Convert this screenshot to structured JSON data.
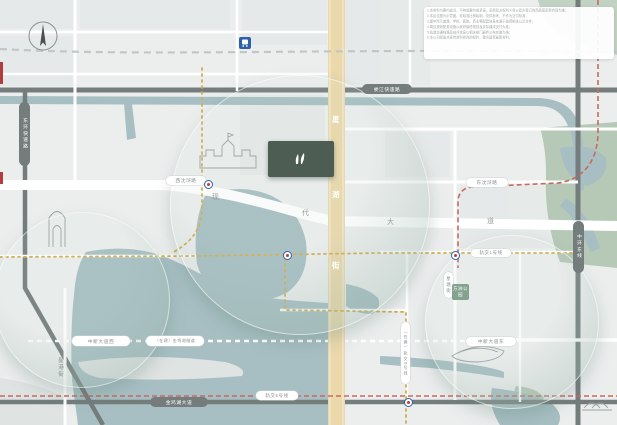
{
  "logo": {
    "name": "朗拾",
    "sub": "ILE MAISON",
    "color": "#4d5d53"
  },
  "compass": {
    "label": "北/North"
  },
  "zones": {
    "hudong": "湖东核心CBD",
    "huxi": "湖西CBD",
    "aoti": "奥体板块",
    "lake": "金鸡湖"
  },
  "disclaimer": {
    "lines": [
      "1.本资料为要约邀请，不构成要约或承诺，买卖双方权利义务以双方签订的商品房买卖合同为准；",
      "2.本区位图为示意图，非精准比例绘制，仅供参考，不作为交付标准；",
      "3.图中所示道路、学校、医院、商业等配套信息来源于政府相关公示文件；",
      "4.周边规划配套设施以政府最终规划及实际建成交付为准；",
      "5.轨道交通线路及站点信息以相关部门最终公布实施为准；",
      "6.本公司保留对宣传资料修改的权利，敬请留意最新资料。"
    ]
  },
  "map": {
    "accent_gold_road": "#ebd8ab",
    "water_color": "#a7bfc3",
    "park_color": "#b6c9b7",
    "labels": [
      {
        "n": "north-label",
        "x": 34,
        "y": 20,
        "text": "北/North",
        "fs": 4.5,
        "color": "#777777"
      },
      {
        "n": "xinsu-industrial",
        "x": 114,
        "y": 14,
        "text": "新苏工业坊",
        "icon": "bld",
        "side": "r"
      },
      {
        "n": "aosheng-plaza",
        "x": 132,
        "y": 38,
        "text": "禧中奥盛生活广场",
        "icon": "shop",
        "side": "r"
      },
      {
        "n": "times-shopping-plaza",
        "x": 134,
        "y": 54,
        "text": "苏州时代购物广场",
        "icon": "shop",
        "side": "l"
      },
      {
        "n": "hotel-pingjiang",
        "x": 237,
        "y": 13,
        "text": "平江国际酒店",
        "icon": "bld",
        "side": "r"
      },
      {
        "n": "suzhou-park-station",
        "x": 229,
        "y": 54,
        "text": "苏州园区站",
        "fs": 5.5,
        "bold": true,
        "color": "#2c3a46"
      },
      {
        "n": "vanke-life-plaza",
        "x": 137,
        "y": 154,
        "text": "万科生活广场",
        "icon": "shop",
        "side": "r"
      },
      {
        "n": "xinghai-school",
        "x": 210,
        "y": 166,
        "text": "星海实验中学",
        "fs": 5.2
      },
      {
        "n": "expo-center",
        "x": 151,
        "y": 214,
        "text": "苏州国际博览中心",
        "icon": "bld",
        "side": "r"
      },
      {
        "n": "culture-art-center",
        "x": 166,
        "y": 225,
        "lines": [
          "苏州文化",
          "艺术中心"
        ],
        "icon": "bld",
        "side": "l"
      },
      {
        "n": "wenbo-plaza",
        "x": 196,
        "y": 232,
        "text": "文博商业广场",
        "icon": "shop",
        "side": "l"
      },
      {
        "n": "shinkong-place",
        "x": 253,
        "y": 232,
        "text": "新光天地",
        "icon": "shop",
        "side": "l"
      },
      {
        "n": "moonlight-wharf",
        "x": 193,
        "y": 261,
        "text": "月光码头",
        "icon": "shop",
        "side": "l"
      },
      {
        "n": "eslite-bookstore",
        "x": 229,
        "y": 261,
        "text": "诚品书店",
        "icon": "shop",
        "side": "r"
      },
      {
        "n": "harmony-times-square",
        "x": 257,
        "y": 272,
        "text": "圆融时代广场",
        "icon": "shop",
        "side": "l"
      },
      {
        "n": "jiuguang-dept",
        "x": 279,
        "y": 286,
        "text": "久光百货",
        "icon": "shop",
        "side": "l"
      },
      {
        "n": "harmony-mall",
        "x": 281,
        "y": 298,
        "text": "圆融购物中心",
        "icon": "shop",
        "side": "l"
      },
      {
        "n": "wharf-ifc",
        "x": 296,
        "y": 251,
        "lines": [
          "苏州九龙仓",
          "国际金融中心"
        ],
        "icon": "bld",
        "side": "b"
      },
      {
        "n": "sip-administration",
        "x": 352,
        "y": 235,
        "lines": [
          "苏州工业园区",
          "管理委员会"
        ],
        "icon": "gov",
        "side": "t"
      },
      {
        "n": "sip-service-center",
        "x": 415,
        "y": 234,
        "lines": [
          "苏州工业园区",
          "行政服务中心"
        ],
        "icon": "bld",
        "side": "l"
      },
      {
        "n": "jiulong-hospital",
        "x": 392,
        "y": 187,
        "text": "九龙医院",
        "icon": "hosp",
        "side": "b"
      },
      {
        "n": "jingcheng-neighborhood",
        "x": 384,
        "y": 206,
        "text": "景城邻里中心",
        "icon": "shop",
        "side": "l"
      },
      {
        "n": "samsung-electronics",
        "x": 487,
        "y": 145,
        "text": "苏州三星电子有限公司",
        "icon": "bld",
        "side": "l"
      },
      {
        "n": "dongshahu-neighborhood",
        "x": 487,
        "y": 192,
        "text": "东沙湖邻里中心",
        "icon": "shop",
        "side": "r"
      },
      {
        "n": "vanke-city-garden",
        "x": 457,
        "y": 201,
        "text": "万科城市花园",
        "icon": "shop",
        "side": "l"
      },
      {
        "n": "hudong-neighborhood",
        "x": 358,
        "y": 296,
        "text": "湖东邻里中心",
        "icon": "shop",
        "side": "l"
      },
      {
        "n": "modern-media-plaza",
        "x": 380,
        "y": 258,
        "text": "现代传媒广场",
        "icon": "bld",
        "side": "r"
      },
      {
        "n": "dongshahu-eco-park",
        "x": 589,
        "y": 192,
        "lines": [
          "东沙湖",
          "生态公园"
        ],
        "color": "#ffffff",
        "fs": 4.8
      },
      {
        "n": "aeon-mall",
        "x": 492,
        "y": 272,
        "text": "永旺梦乐城",
        "icon": "shop",
        "side": "r"
      },
      {
        "n": "yuanhe-qingyue",
        "x": 473,
        "y": 288,
        "lines": [
          "元禾青",
          "悦景中心"
        ],
        "icon": "shop",
        "side": "r"
      },
      {
        "n": "xinghui-school",
        "x": 523,
        "y": 292,
        "text": "星汇学校",
        "icon": "sch",
        "side": "l"
      },
      {
        "n": "fangzhou-primary",
        "x": 477,
        "y": 310,
        "lines": [
          "苏州工业园区",
          "方洲小学"
        ],
        "icon": "sch",
        "side": "l"
      },
      {
        "n": "children-hospital",
        "x": 524,
        "y": 309,
        "lines": [
          "苏州大学附属",
          "儿童医院园区总院"
        ],
        "icon": "hosp",
        "side": "l"
      },
      {
        "n": "sports-center",
        "x": 462,
        "y": 359,
        "text": "奥体中心",
        "fs": 5.2
      },
      {
        "n": "foreign-language-school",
        "x": 508,
        "y": 346,
        "lines": [
          "苏州工业园区",
          "外国语学校"
        ],
        "icon": "sch",
        "side": "l"
      },
      {
        "n": "yihe-linglong",
        "x": 512,
        "y": 367,
        "text": "颐和玲珑",
        "icon": "bld",
        "side": "l"
      },
      {
        "n": "meisong-center",
        "x": 455,
        "y": 371,
        "text": "美颂中心",
        "icon": "shop",
        "side": "l"
      },
      {
        "n": "xinglan-school",
        "x": 487,
        "y": 381,
        "text": "星澜学校",
        "icon": "sch",
        "side": "l"
      },
      {
        "n": "vanke-cofco",
        "x": 420,
        "y": 378,
        "text": "万科中粮本岸",
        "icon": "bld",
        "side": "l"
      },
      {
        "n": "jinhua-center",
        "x": 382,
        "y": 366,
        "text": "锦华中心",
        "icon": "bld",
        "side": "l"
      },
      {
        "n": "rtmart-hudong",
        "x": 460,
        "y": 394,
        "text": "湖东大润发",
        "icon": "shop",
        "side": "l"
      },
      {
        "n": "xinghu-hospital",
        "x": 408,
        "y": 407,
        "text": "星湖医院",
        "icon": "hosp",
        "side": "l"
      },
      {
        "n": "dulwich-school",
        "x": 589,
        "y": 344,
        "lines": [
          "苏州德威",
          "国际高中"
        ],
        "icon": "bld",
        "side": "t"
      },
      {
        "n": "kempinski-hotel",
        "x": 225,
        "y": 406,
        "text": "凯宾斯基酒店",
        "icon": "bld",
        "side": "l"
      },
      {
        "n": "linrui-plaza",
        "x": 288,
        "y": 406,
        "text": "邻瑞广场",
        "icon": "shop",
        "side": "r"
      },
      {
        "n": "xietang-old-street",
        "x": 351,
        "y": 362,
        "text": "斜塘老街",
        "icon": "shop",
        "side": "l"
      },
      {
        "n": "ligongdi",
        "x": 108,
        "y": 354,
        "text": "李公堤",
        "icon": "bld",
        "side": "l"
      },
      {
        "n": "jinji-lake",
        "x": 141,
        "y": 302,
        "text": "金鸡湖",
        "fs": 9,
        "color": "#8fa9ac",
        "ls": 7
      },
      {
        "n": "huxi-cbd",
        "x": 34,
        "y": 269,
        "text": "湖西CBD",
        "fs": 12,
        "bold": true,
        "color": "#6f9c97",
        "ls": 1
      },
      {
        "n": "suzhou-center",
        "x": 20,
        "y": 234,
        "lines": [
          "苏州",
          "中心"
        ],
        "icon": "shop",
        "side": "t",
        "fs": 4.3
      },
      {
        "n": "gate-of-orient",
        "x": 46,
        "y": 242,
        "text": "东方之门",
        "fs": 4.5
      },
      {
        "n": "linglong-business-center",
        "x": 21,
        "y": 255,
        "text": "玲珑商务中心",
        "icon": "bld",
        "side": "t"
      },
      {
        "n": "hudong-core-cbd",
        "x": 249,
        "y": 186,
        "text": "湖东核心CBD",
        "fs": 13,
        "bold": true,
        "color": "#33524c",
        "ls": 1.5
      },
      {
        "n": "aoti-zone",
        "x": 485,
        "y": 323,
        "text": "奥体板块",
        "fs": 12,
        "bold": true,
        "color": "#5b8a82",
        "ls": 3
      }
    ],
    "pills": [
      {
        "n": "loujiang-expressway",
        "text": "娄江快速路",
        "x": 362,
        "y": 84,
        "w": 50,
        "h": 10,
        "k": "dark"
      },
      {
        "n": "donghuan-expressway",
        "text": "东环快速路",
        "x": 19,
        "y": 102,
        "w": 11,
        "h": 64,
        "k": "dark",
        "v": true
      },
      {
        "n": "zhonghuan-east",
        "text": "中环东线",
        "x": 573,
        "y": 221,
        "w": 11,
        "h": 52,
        "k": "dark",
        "v": true
      },
      {
        "n": "jinjihu-avenue",
        "text": "金鸡湖大道",
        "x": 150,
        "y": 397,
        "w": 58,
        "h": 10,
        "k": "dark"
      },
      {
        "n": "xishenhu-road",
        "text": "西沈浒路",
        "x": 166,
        "y": 176,
        "w": 40,
        "h": 9,
        "k": "white"
      },
      {
        "n": "dongshenhu-road",
        "text": "东沈浒路",
        "x": 466,
        "y": 178,
        "w": 42,
        "h": 9,
        "k": "white"
      },
      {
        "n": "zhongxin-avenue-west",
        "text": "中新大道西",
        "x": 72,
        "y": 336,
        "w": 58,
        "h": 10,
        "k": "white"
      },
      {
        "n": "jinjihu-tunnel",
        "text": "（在建）金鸡湖隧道",
        "x": 146,
        "y": 336,
        "w": 58,
        "h": 10,
        "k": "white",
        "fs": 4
      },
      {
        "n": "zhongxin-avenue-east",
        "text": "中新大道东",
        "x": 466,
        "y": 337,
        "w": 50,
        "h": 9,
        "k": "white"
      },
      {
        "n": "metro-line1",
        "text": "轨交1号线",
        "x": 471,
        "y": 249,
        "w": 40,
        "h": 8,
        "k": "white",
        "fs": 4.5
      },
      {
        "n": "metro-line5",
        "text": "轨交5号线",
        "x": 256,
        "y": 391,
        "w": 42,
        "h": 9,
        "k": "white",
        "fs": 4.5
      },
      {
        "n": "xingtang-street",
        "text": "星塘街",
        "x": 444,
        "y": 272,
        "w": 9,
        "h": 26,
        "k": "white",
        "v": true,
        "fs": 4.5
      },
      {
        "n": "metro-line6",
        "text": "（在建）轨交6号线",
        "x": 401,
        "y": 322,
        "w": 9,
        "h": 62,
        "k": "white",
        "v": true,
        "fs": 4
      },
      {
        "n": "fangzhou-park",
        "text": "方洲公园",
        "x": 452,
        "y": 284,
        "w": 17,
        "h": 16,
        "k": "green",
        "fs": 4.5
      },
      {
        "n": "xinggang-street",
        "text": "星港街",
        "x": 55,
        "y": 351,
        "w": 10,
        "h": 32,
        "k": "plain",
        "v": true,
        "fs": 5.5
      }
    ],
    "road_chars": [
      {
        "n": "modern-avenue-char1",
        "t": "现",
        "x": 212,
        "y": 192,
        "c": "#979e9d"
      },
      {
        "n": "modern-avenue-char2",
        "t": "代",
        "x": 302,
        "y": 208,
        "c": "#979e9d"
      },
      {
        "n": "modern-avenue-char3",
        "t": "大",
        "x": 387,
        "y": 217,
        "c": "#979e9d"
      },
      {
        "n": "modern-avenue-char4",
        "t": "道",
        "x": 487,
        "y": 216,
        "c": "#979e9d"
      },
      {
        "n": "xinghu-street-char1",
        "t": "星",
        "x": 332,
        "y": 114,
        "c": "#ffffff"
      },
      {
        "n": "xinghu-street-char2",
        "t": "湖",
        "x": 332,
        "y": 189,
        "c": "#ffffff"
      },
      {
        "n": "xinghu-street-char3",
        "t": "街",
        "x": 332,
        "y": 260,
        "c": "#ffffff"
      }
    ],
    "metro_stations": [
      {
        "x": 204,
        "y": 180
      },
      {
        "x": 283,
        "y": 251
      },
      {
        "x": 451,
        "y": 251
      },
      {
        "x": 404,
        "y": 398
      }
    ]
  }
}
